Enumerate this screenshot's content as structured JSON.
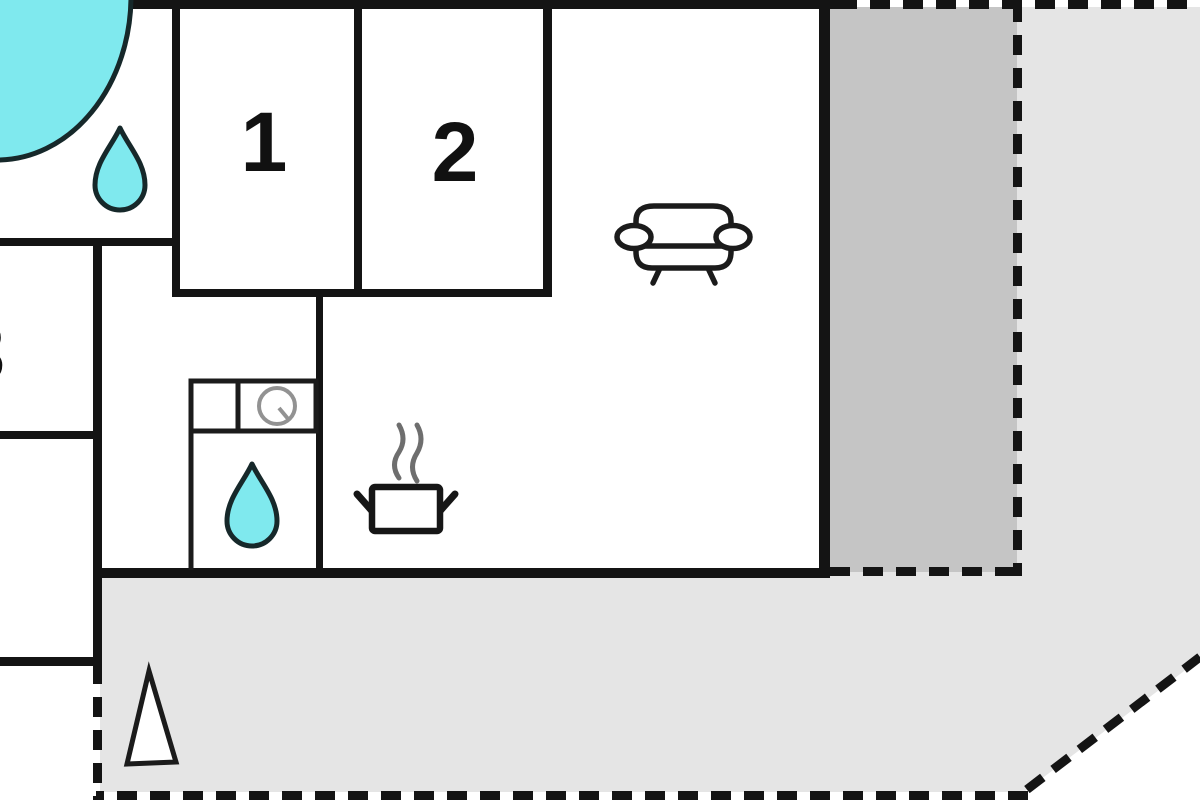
{
  "plan": {
    "type": "floor-plan",
    "rooms": [
      {
        "label": "1"
      },
      {
        "label": "2"
      },
      {
        "label": "3"
      }
    ],
    "icons": {
      "bathtub": "corner bathtub",
      "water_drop": "water drop (bathroom)",
      "washing_machine": "washing machine",
      "cooking_pot": "cooking pot with steam (kitchen)",
      "sofa": "sofa (living room)",
      "north_arrow": "north arrow triangle"
    }
  },
  "colors": {
    "wall": "#141414",
    "water_fill": "#7FE9EE",
    "water_stroke": "#16282a",
    "terrace_covered": "#C5C5C5",
    "terrace_open": "#E5E5E5",
    "label": "#111111"
  }
}
